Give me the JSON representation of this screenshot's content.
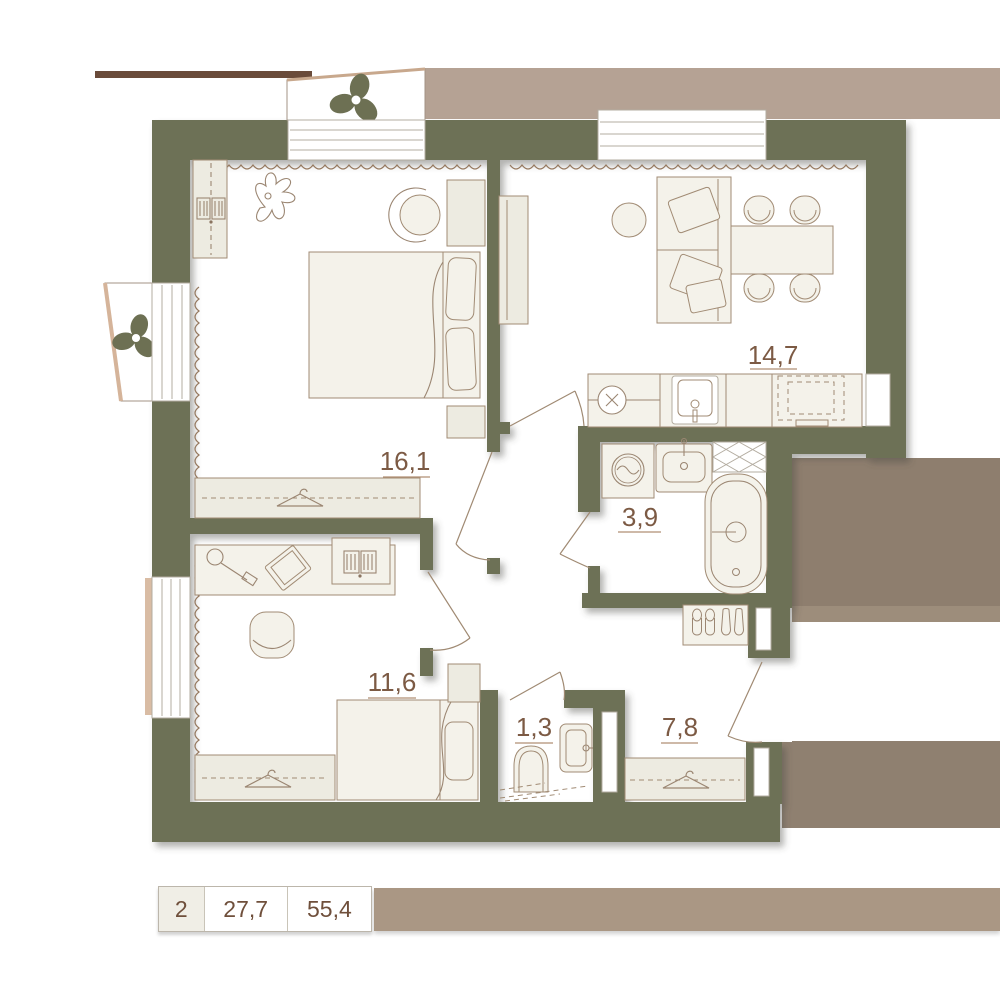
{
  "plan": {
    "rooms": [
      {
        "name": "bedroom",
        "area": "16,1"
      },
      {
        "name": "living-kitchen",
        "area": "14,7"
      },
      {
        "name": "bathroom",
        "area": "3,9"
      },
      {
        "name": "bedroom-2",
        "area": "11,6"
      },
      {
        "name": "wc",
        "area": "1,3"
      },
      {
        "name": "hallway",
        "area": "7,8"
      }
    ],
    "summary": {
      "rooms_count": "2",
      "living_area": "27,7",
      "total_area": "55,4"
    },
    "colors": {
      "wall": "#6d7156",
      "tan_band": "#b5a294",
      "tan_block": "#8e7e6e",
      "tan_block_lower": "#8f8070",
      "bottom_bar": "#aa9784",
      "dark_bar": "#6a4b3a",
      "label_text": "#7c5a44"
    }
  }
}
